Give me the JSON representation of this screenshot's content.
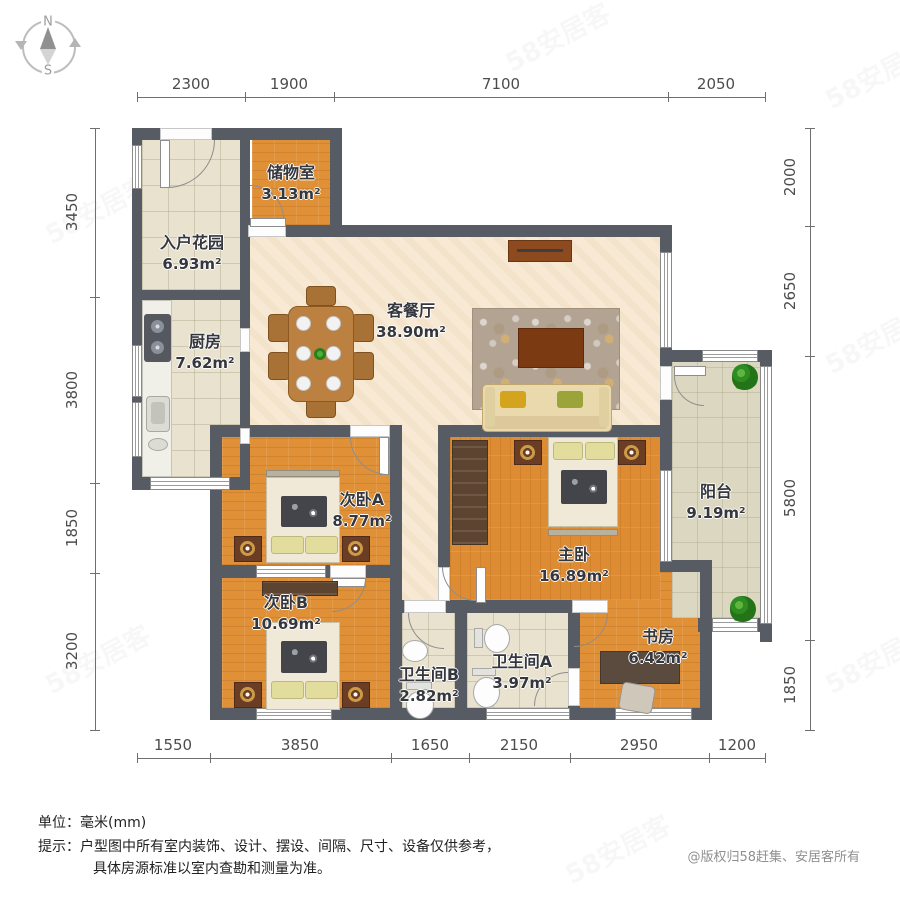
{
  "compass": {
    "n": "N",
    "s": "S"
  },
  "dims": {
    "top": [
      "2300",
      "1900",
      "7100",
      "2050"
    ],
    "bottom": [
      "1550",
      "3850",
      "1650",
      "2150",
      "2950",
      "1200"
    ],
    "left": [
      "3450",
      "3800",
      "1850",
      "3200"
    ],
    "right": [
      "2000",
      "2650",
      "5800",
      "1850"
    ]
  },
  "rooms": {
    "entry_garden": {
      "name": "入户花园",
      "area": "6.93m²"
    },
    "storage": {
      "name": "储物室",
      "area": "3.13m²"
    },
    "kitchen": {
      "name": "厨房",
      "area": "7.62m²"
    },
    "living_dining": {
      "name": "客餐厅",
      "area": "38.90m²"
    },
    "bedroom_a": {
      "name": "次卧A",
      "area": "8.77m²"
    },
    "bedroom_b": {
      "name": "次卧B",
      "area": "10.69m²"
    },
    "master_bedroom": {
      "name": "主卧",
      "area": "16.89m²"
    },
    "balcony": {
      "name": "阳台",
      "area": "9.19m²"
    },
    "study": {
      "name": "书房",
      "area": "6.42m²"
    },
    "bathroom_a": {
      "name": "卫生间A",
      "area": "3.97m²"
    },
    "bathroom_b": {
      "name": "卫生间B",
      "area": "2.82m²"
    }
  },
  "footer": {
    "unit_label": "单位：",
    "unit_value": "毫米(mm)",
    "tip_label": "提示：",
    "tip_line1": "户型图中所有室内装饰、设计、摆设、间隔、尺寸、设备仅供参考，",
    "tip_line2": "具体房源标准以室内查勘和测量为准。",
    "copyright": "@版权归58赶集、安居客所有"
  },
  "watermark": "58安居客",
  "colors": {
    "wall": "#575b63",
    "wood_floor": "#e09138",
    "living_floor": "#f7e9d3",
    "tile_floor": "#e8e2cf"
  }
}
